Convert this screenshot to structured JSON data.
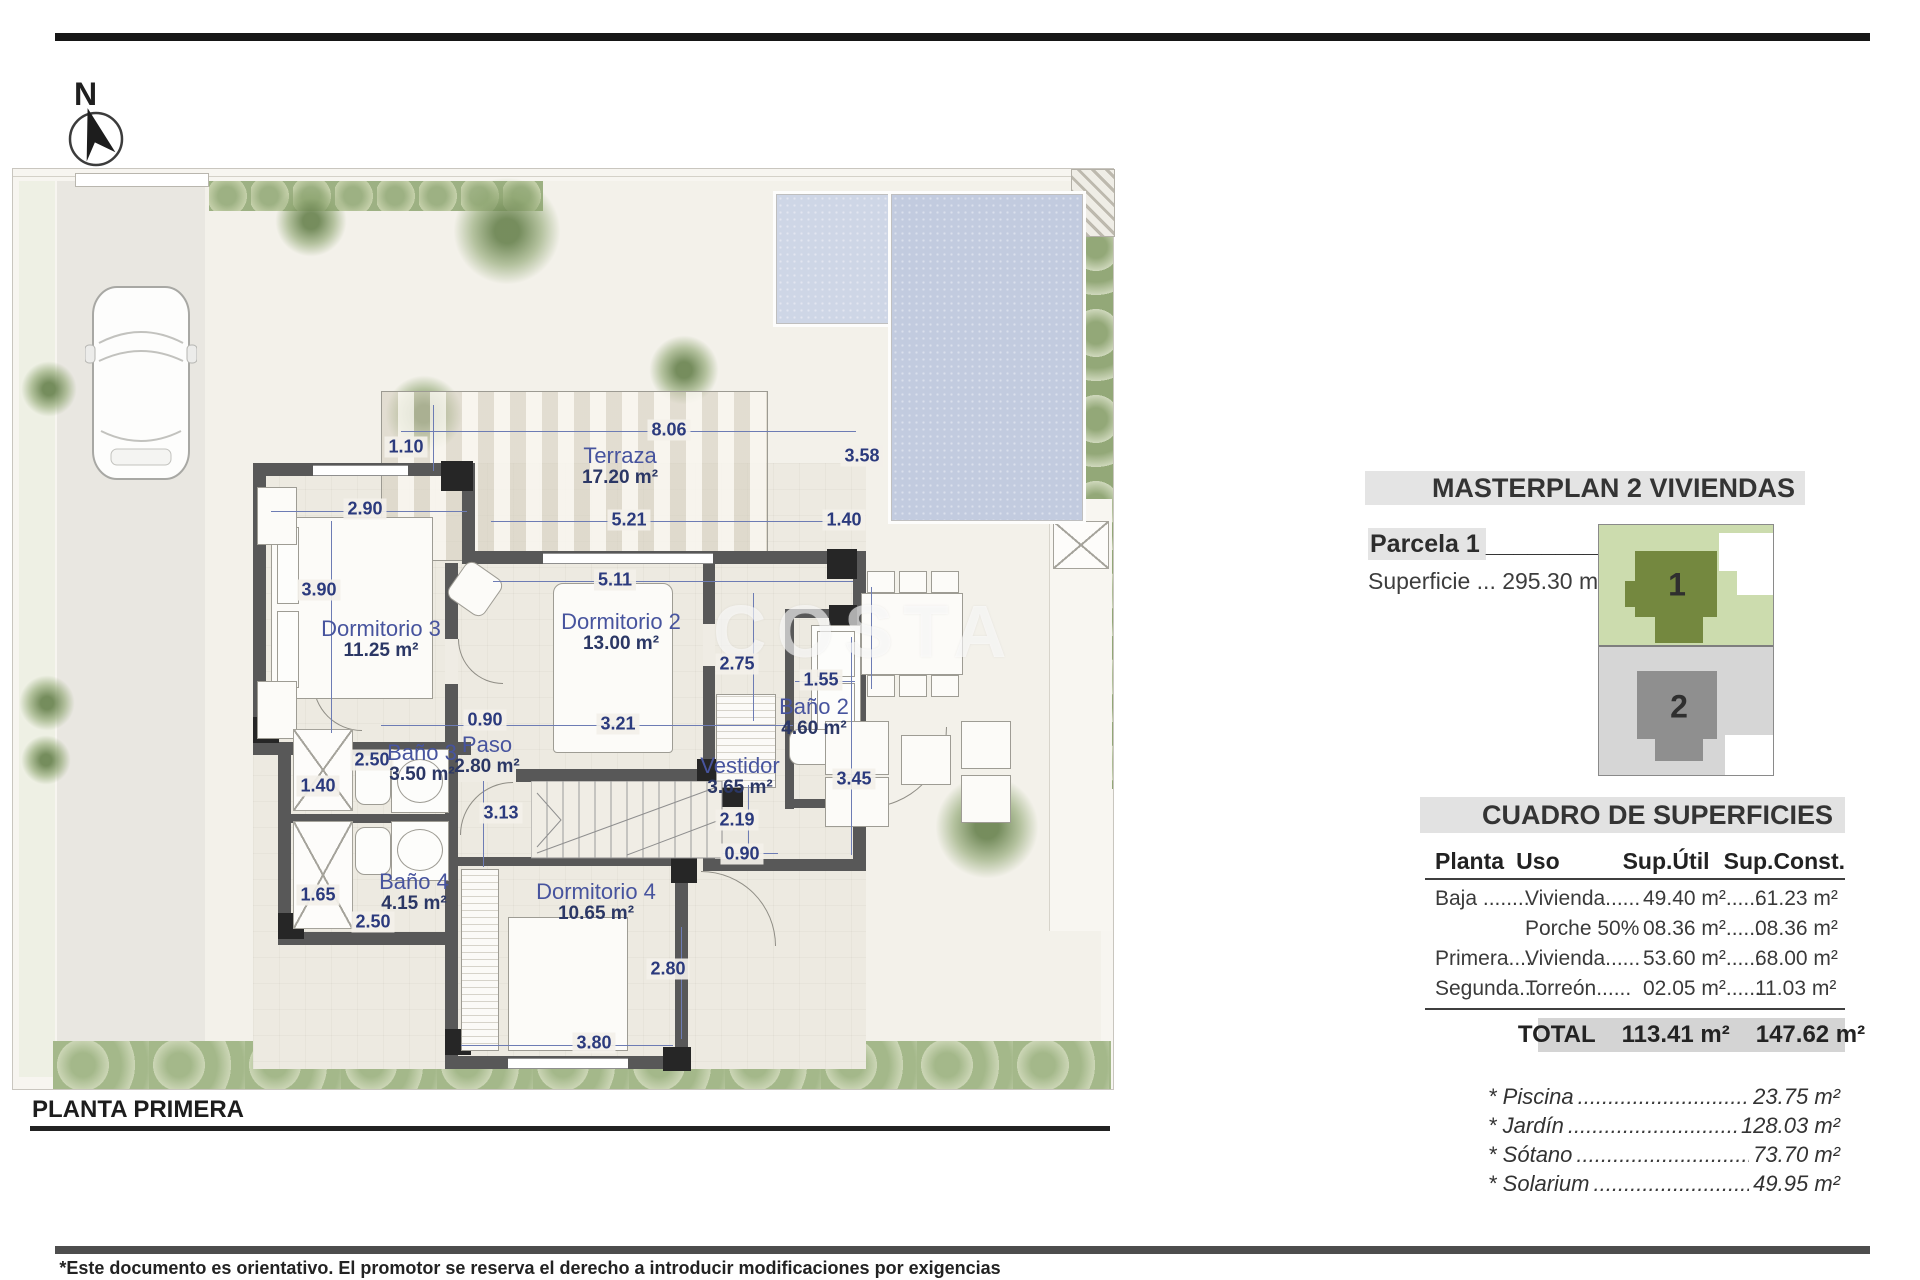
{
  "page": {
    "north_label": "N",
    "plan_title": "PLANTA PRIMERA",
    "watermark": "COSTA",
    "disclaimer": "*Este documento es orientativo. El promotor se reserva el derecho a introducir modificaciones por exigencias técnicas o legales."
  },
  "colors": {
    "accent_blue": "#2b3a7d",
    "wall_gray": "#585858",
    "pool_blue": "#c2cbdf",
    "garden_green": "#ccd6b6",
    "masterplan_green": "#74883f",
    "masterplan_gray": "#8f8f8f",
    "panel_bar_gray": "#e4e4e4"
  },
  "masterplan": {
    "title": "MASTERPLAN 2 VIVIENDAS",
    "parcela_label": "Parcela 1",
    "parcela_underscore": "_________",
    "superficie": "Superficie ... 295.30 m²",
    "unit1": "1",
    "unit2": "2"
  },
  "superficies": {
    "title": "CUADRO DE SUPERFICIES",
    "headers": [
      "Planta",
      "Uso",
      "Sup.Útil",
      "Sup.Const."
    ],
    "rows": [
      {
        "planta": "Baja ........",
        "uso": "Vivienda......",
        "util": "49.40 m²......",
        "construida": "61.23 m²"
      },
      {
        "planta": "",
        "uso": "Porche 50%",
        "util": "08.36 m²......",
        "construida": "08.36 m²"
      },
      {
        "planta": "Primera....",
        "uso": "Vivienda......",
        "util": "53.60 m²......",
        "construida": "68.00 m²"
      },
      {
        "planta": "Segunda...",
        "uso": "Torreón......",
        "util": "02.05 m²......",
        "construida": "11.03 m²"
      }
    ],
    "total_label": "TOTAL",
    "total_util": "113.41 m²",
    "total_const": "147.62 m²"
  },
  "extras": [
    {
      "label": "* Piscina",
      "value": "23.75 m²"
    },
    {
      "label": "* Jardín",
      "value": "128.03 m²"
    },
    {
      "label": "* Sótano",
      "value": "73.70 m²"
    },
    {
      "label": "* Solarium",
      "value": "49.95 m²"
    }
  ],
  "plan": {
    "rooms": [
      {
        "id": "terraza",
        "name": "Terraza",
        "area": "17.20 m²",
        "x": 607,
        "y": 297
      },
      {
        "id": "dormitorio3",
        "name": "Dormitorio 3",
        "area": "11.25 m²",
        "x": 368,
        "y": 470
      },
      {
        "id": "dormitorio2",
        "name": "Dormitorio 2",
        "area": "13.00 m²",
        "x": 608,
        "y": 463
      },
      {
        "id": "bano2",
        "name": "Baño 2",
        "area": "4.60 m²",
        "x": 801,
        "y": 548
      },
      {
        "id": "vestidor",
        "name": "Vestidor",
        "area": "3.65 m²",
        "x": 727,
        "y": 607
      },
      {
        "id": "paso",
        "name": "Paso",
        "area": "2.80 m²",
        "x": 474,
        "y": 586
      },
      {
        "id": "bano3",
        "name": "Baño 3",
        "area": "3.50 m²",
        "x": 409,
        "y": 594
      },
      {
        "id": "bano4",
        "name": "Baño 4",
        "area": "4.15 m²",
        "x": 401,
        "y": 723
      },
      {
        "id": "dormitorio4",
        "name": "Dormitorio 4",
        "area": "10.65 m²",
        "x": 583,
        "y": 733
      }
    ],
    "dims": [
      {
        "text": "8.06",
        "x": 656,
        "y": 261
      },
      {
        "text": "1.10",
        "x": 393,
        "y": 278
      },
      {
        "text": "3.58",
        "x": 849,
        "y": 287
      },
      {
        "text": "2.90",
        "x": 352,
        "y": 340
      },
      {
        "text": "5.21",
        "x": 616,
        "y": 351
      },
      {
        "text": "1.40",
        "x": 831,
        "y": 351
      },
      {
        "text": "5.11",
        "x": 602,
        "y": 411
      },
      {
        "text": "3.90",
        "x": 306,
        "y": 421
      },
      {
        "text": "2.75",
        "x": 724,
        "y": 495
      },
      {
        "text": "1.55",
        "x": 808,
        "y": 511
      },
      {
        "text": "0.90",
        "x": 472,
        "y": 551
      },
      {
        "text": "3.21",
        "x": 605,
        "y": 555
      },
      {
        "text": "2.50",
        "x": 359,
        "y": 591
      },
      {
        "text": "1.40",
        "x": 305,
        "y": 617
      },
      {
        "text": "3.45",
        "x": 841,
        "y": 610
      },
      {
        "text": "3.13",
        "x": 488,
        "y": 644
      },
      {
        "text": "2.19",
        "x": 724,
        "y": 651
      },
      {
        "text": "0.90",
        "x": 729,
        "y": 685
      },
      {
        "text": "1.65",
        "x": 305,
        "y": 726
      },
      {
        "text": "2.50",
        "x": 360,
        "y": 753
      },
      {
        "text": "2.80",
        "x": 655,
        "y": 800
      },
      {
        "text": "3.80",
        "x": 581,
        "y": 874
      }
    ]
  }
}
